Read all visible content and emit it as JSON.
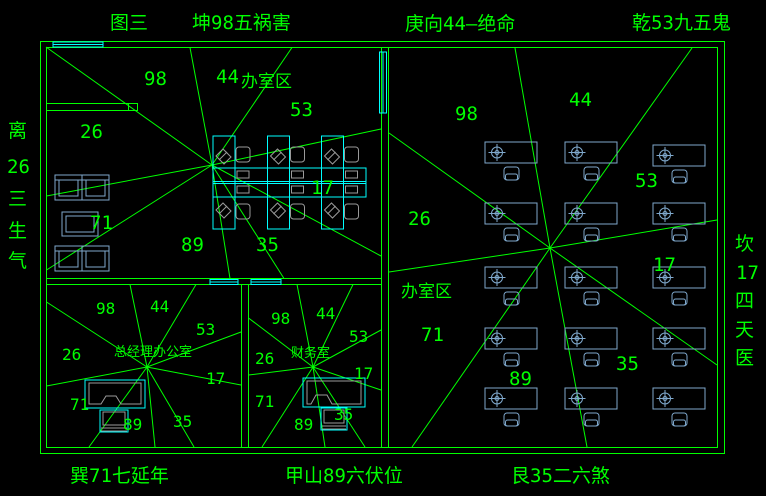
{
  "colors": {
    "line": "#00ff00",
    "window": "#00ffff",
    "furniture": "#7fa8cc",
    "detail": "#9a9a9a",
    "background": "#000000"
  },
  "outer_labels": {
    "top": [
      {
        "text": "图三"
      },
      {
        "text": "坤98五祸害"
      },
      {
        "text": "庚向44—绝命"
      },
      {
        "text": "乾53九五鬼"
      }
    ],
    "bottom": [
      {
        "text": "巽71七延年"
      },
      {
        "text": "甲山89六伏位"
      },
      {
        "text": "艮35二六煞"
      }
    ],
    "left_chars": [
      "离",
      "26",
      "三",
      "生",
      "气"
    ],
    "right_chars": [
      "坎",
      "17",
      "四",
      "天",
      "医"
    ]
  },
  "areas": {
    "main_left": {
      "label": "办室区",
      "numbers": {
        "n98": "98",
        "n44": "44",
        "n53": "53",
        "n26": "26",
        "n17": "17",
        "n71": "71",
        "n89": "89",
        "n35": "35"
      }
    },
    "main_right": {
      "label": "办室区",
      "numbers": {
        "n98": "98",
        "n44": "44",
        "n53": "53",
        "n26": "26",
        "n17": "17",
        "n71": "71",
        "n89": "89",
        "n35": "35"
      }
    },
    "gm_office": {
      "label": "总经理办公室",
      "numbers": {
        "n98": "98",
        "n44": "44",
        "n53": "53",
        "n26": "26",
        "n17": "17",
        "n71": "71",
        "n89": "89",
        "n35": "35"
      }
    },
    "finance": {
      "label": "财务室",
      "numbers": {
        "n98": "98",
        "n44": "44",
        "n53": "53",
        "n26": "26",
        "n17": "17",
        "n71": "71",
        "n89": "89",
        "n35": "35"
      }
    }
  }
}
